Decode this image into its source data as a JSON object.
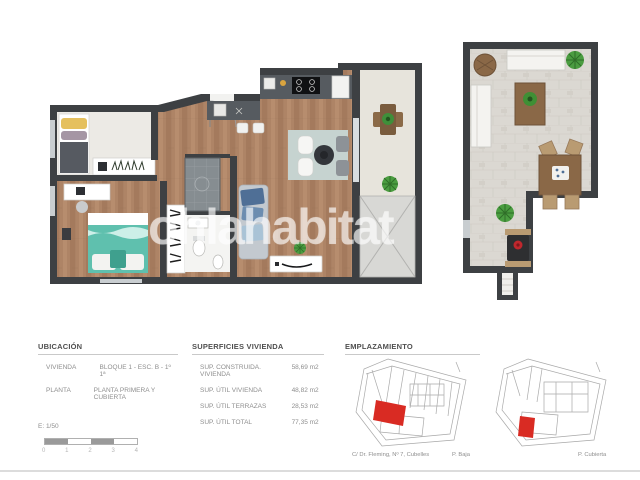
{
  "watermark": "ohlahabitat",
  "ubicacion": {
    "title": "UBICACIÓN",
    "rows": [
      {
        "label": "VIVIENDA",
        "value": "BLOQUE 1 - ESC. B - 1º 1ª"
      },
      {
        "label": "PLANTA",
        "value": "PLANTA PRIMERA Y CUBIERTA"
      }
    ],
    "scale_label": "E: 1/50",
    "scale_ticks": [
      "0",
      "1",
      "2",
      "3",
      "4"
    ]
  },
  "superficies": {
    "title": "SUPERFICIES VIVIENDA",
    "rows": [
      {
        "label": "SUP. CONSTRUIDA. VIVIENDA",
        "value": "58,69 m2"
      },
      {
        "label": "SUP. ÚTIL VIVIENDA",
        "value": "48,82 m2"
      },
      {
        "label": "SUP. ÚTIL TERRAZAS",
        "value": "28,53 m2"
      },
      {
        "label": "SUP. ÚTIL TOTAL",
        "value": "77,35 m2"
      }
    ]
  },
  "emplazamiento": {
    "title": "EMPLAZAMIENTO",
    "address": "C/ Dr. Fleming, Nº 7, Cubelles",
    "plan1_label": "P. Baja",
    "plan2_label": "P. Cubierta"
  },
  "plans": {
    "main_plan_name": "planta primera - vivienda",
    "roof_plan_name": "planta cubierta - terraza"
  },
  "colors": {
    "wall": "#3d4043",
    "wood_floor": "#ad8365",
    "terrace_tile": "#e7e4dc",
    "stone_floor": "#dbd8d2",
    "bed_teal": "#5fc0ae",
    "highlight_red": "#d92b23"
  }
}
